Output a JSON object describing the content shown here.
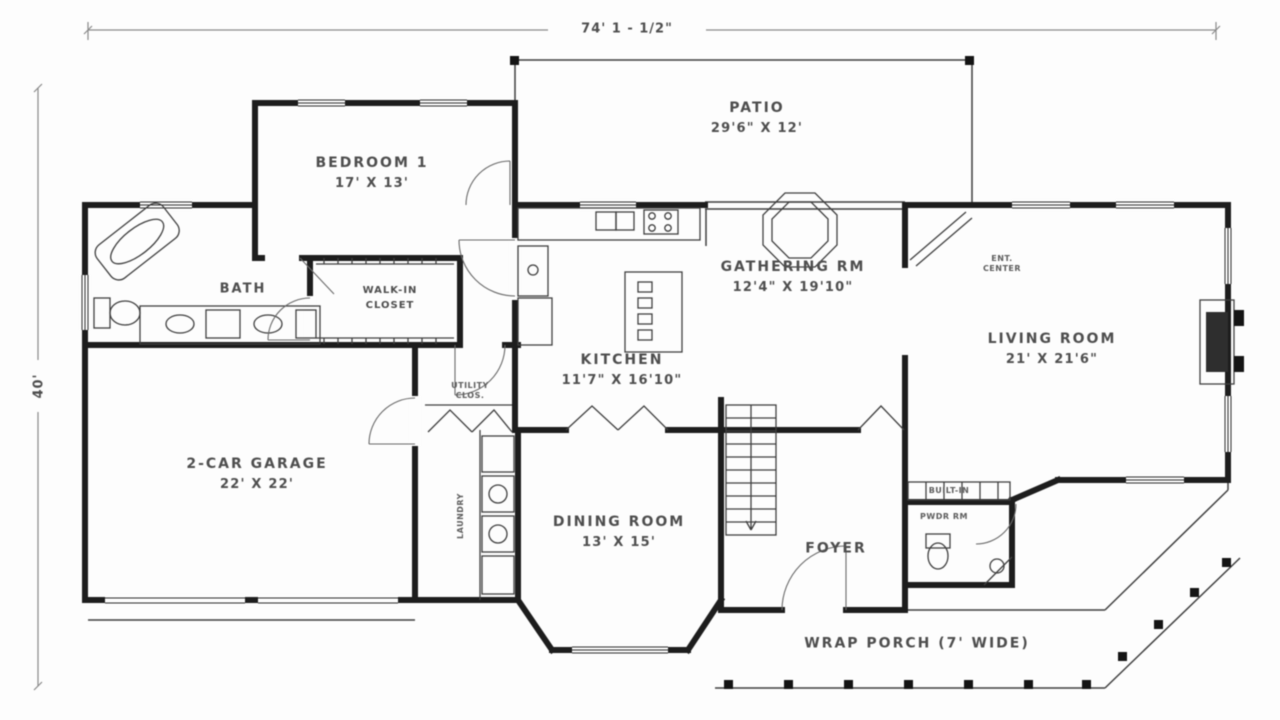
{
  "colors": {
    "wall": "#1d1d1d",
    "thin_line": "#3f3f3f",
    "text": "#4e4e4e",
    "background": "#fdfdfd"
  },
  "dimensions": {
    "overall_width": "74' 1 - 1/2\"",
    "overall_depth": "40'"
  },
  "rooms": {
    "patio": {
      "name": "PATIO",
      "dims": "29'6\" X 12'"
    },
    "bedroom1": {
      "name": "BEDROOM 1",
      "dims": "17' X 13'"
    },
    "bath": {
      "name": "BATH"
    },
    "walkin": {
      "line1": "WALK-IN",
      "line2": "CLOSET"
    },
    "gathering": {
      "name": "GATHERING RM",
      "dims": "12'4\" X 19'10\""
    },
    "ent": {
      "line1": "ENT.",
      "line2": "CENTER"
    },
    "kitchen": {
      "name": "KITCHEN",
      "dims": "11'7\" X 16'10\""
    },
    "living": {
      "name": "LIVING ROOM",
      "dims": "21' X 21'6\""
    },
    "garage": {
      "name": "2-CAR GARAGE",
      "dims": "22' X 22'"
    },
    "utility": {
      "line1": "UTILITY",
      "line2": "CLOS."
    },
    "laundry": {
      "name": "LAUNDRY"
    },
    "dining": {
      "name": "DINING ROOM",
      "dims": "13' X 15'"
    },
    "foyer": {
      "name": "FOYER"
    },
    "builtin": {
      "name": "BUILT-IN"
    },
    "pwdr": {
      "name": "PWDR RM"
    },
    "porch": {
      "name": "WRAP PORCH (7' WIDE)"
    }
  }
}
